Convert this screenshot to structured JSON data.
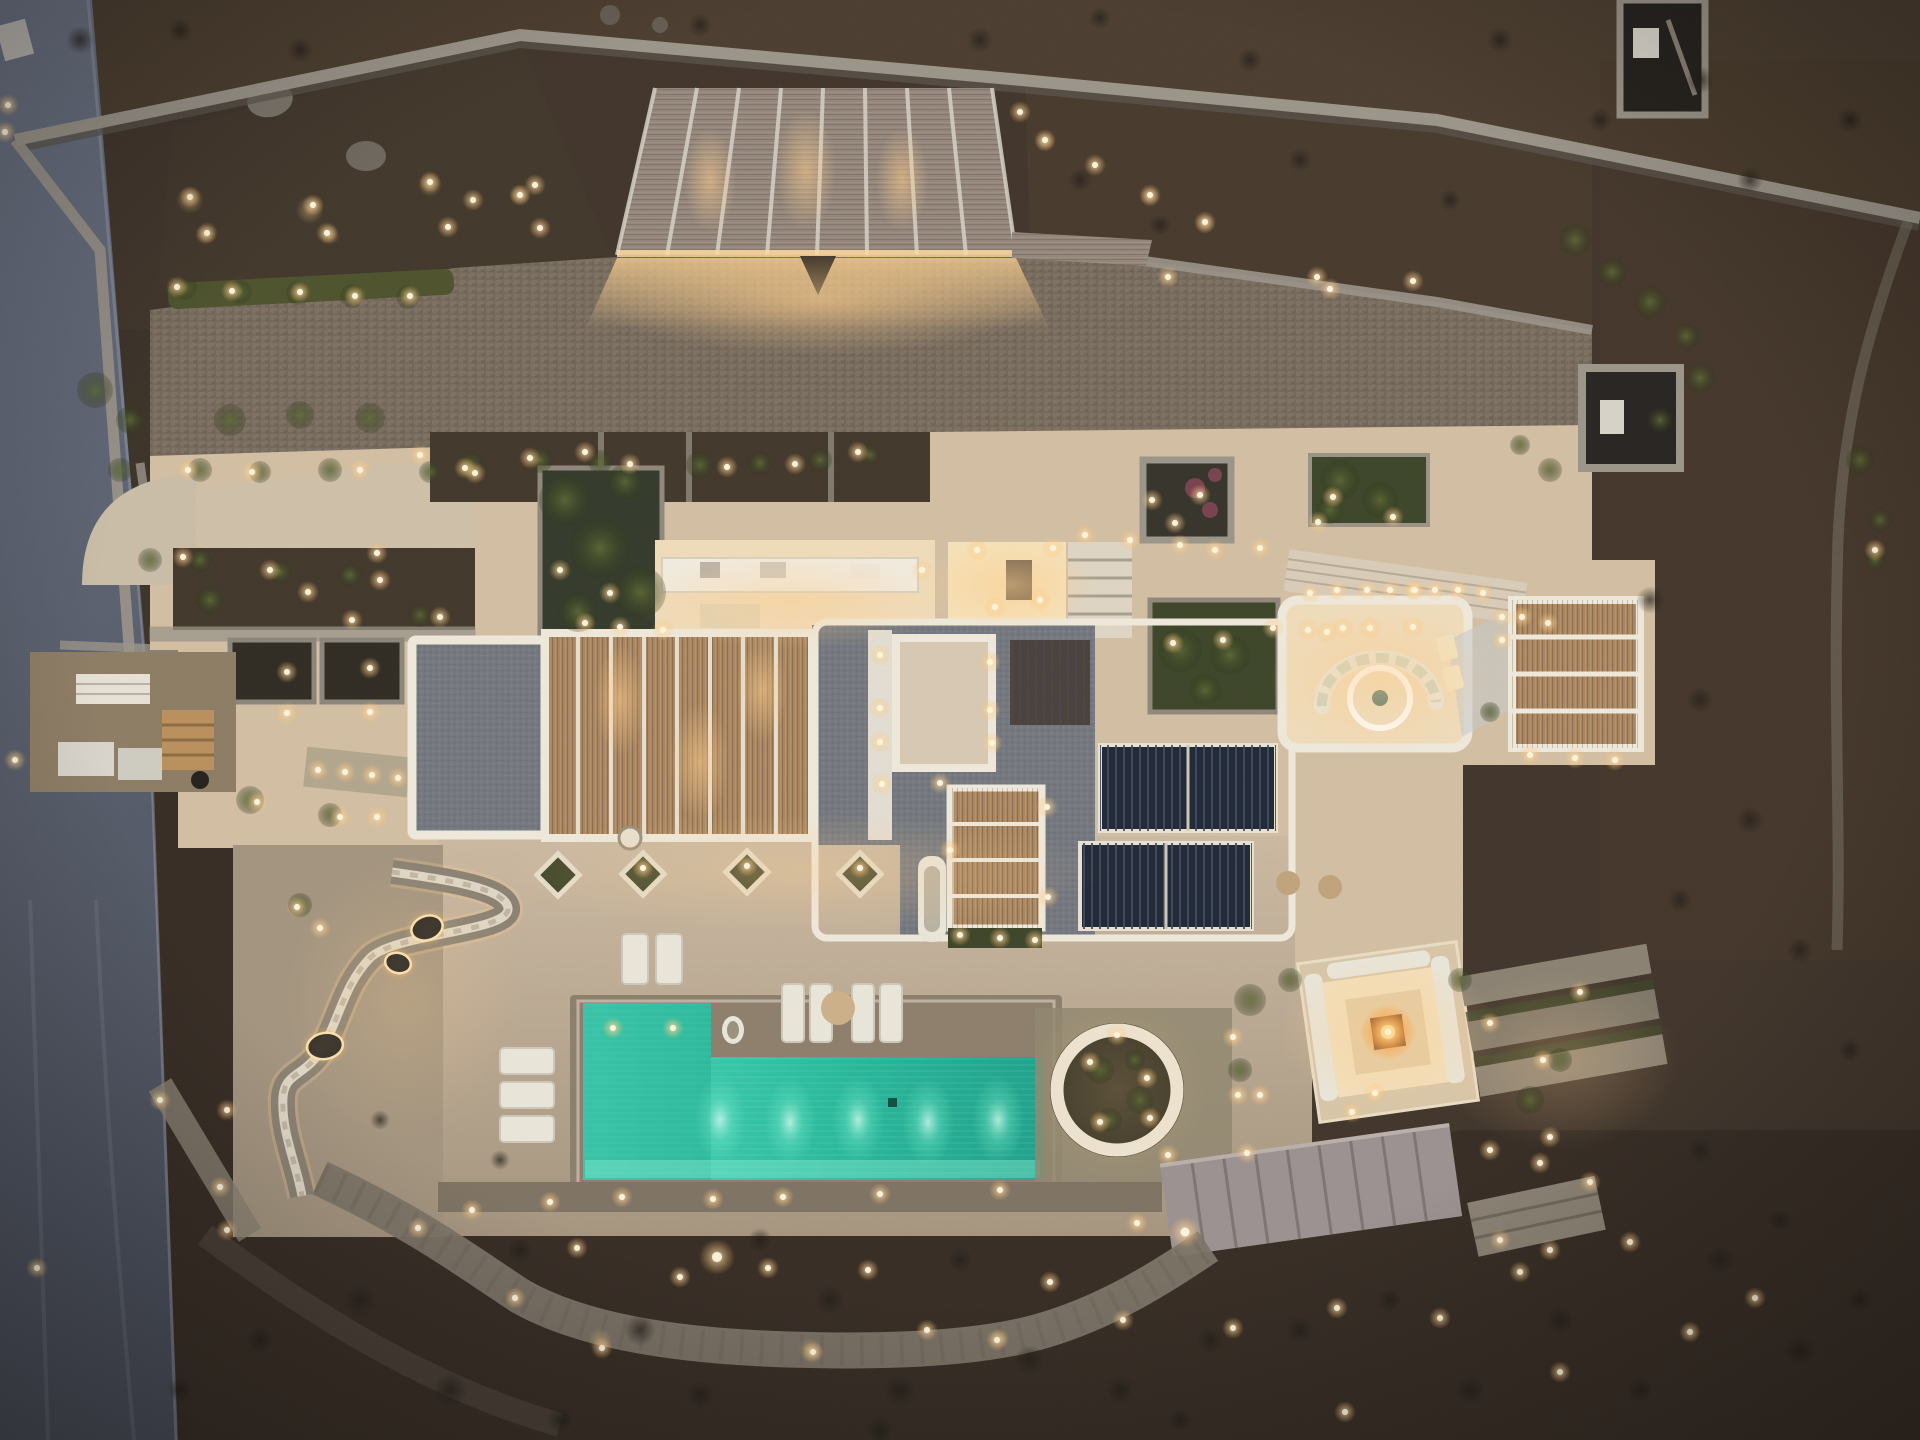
{
  "meta": {
    "label": "Aerial dusk photograph of an illuminated stone villa with pergolas, terraces and a turquoise pool",
    "width": 1920,
    "height": 1440
  },
  "palette": {
    "terrainTop": "#4a3c2e",
    "terrain": "#40342a",
    "terrainBottom": "#352b23",
    "road1": "#6a7183",
    "road2": "#474c59",
    "wall": "#9a9489",
    "wallDark": "#5a544b",
    "cobble": "#75685a",
    "bed": "#41362a",
    "cream": "#d3bfa3",
    "creamHi": "#f0dcba",
    "creamLo": "#b3a28d",
    "white": "#efe9db",
    "thatch": "#93857a",
    "bamboo": "#a9855f",
    "gravel": "#73777e",
    "solar": "#1f2734",
    "pool": "#2abfa3",
    "poolDeep": "#16957e",
    "green": "#3c4428",
    "greenHi": "#5d6a35",
    "stone": "#8a8172",
    "stonePath": "#7c7367",
    "deck": "#c8b59e",
    "deckLo": "#a3947f",
    "sofa": "#e9e6da",
    "cushion": "#c9d2bd",
    "fire": "#ffb057",
    "glow": "#ffd9a0"
  },
  "lights": {
    "warm": [
      [
        190,
        197
      ],
      [
        207,
        233
      ],
      [
        313,
        205
      ],
      [
        327,
        233
      ],
      [
        430,
        182
      ],
      [
        448,
        227
      ],
      [
        473,
        200
      ],
      [
        520,
        195
      ],
      [
        535,
        185
      ],
      [
        540,
        228
      ],
      [
        8,
        105
      ],
      [
        5,
        132
      ],
      [
        177,
        287
      ],
      [
        232,
        291
      ],
      [
        300,
        292
      ],
      [
        355,
        296
      ],
      [
        410,
        296
      ],
      [
        1020,
        112
      ],
      [
        1045,
        140
      ],
      [
        1095,
        165
      ],
      [
        1150,
        195
      ],
      [
        1205,
        222
      ],
      [
        1168,
        277
      ],
      [
        1317,
        277
      ],
      [
        1330,
        289
      ],
      [
        1413,
        281
      ],
      [
        420,
        455
      ],
      [
        465,
        468
      ],
      [
        530,
        458
      ],
      [
        585,
        452
      ],
      [
        630,
        464
      ],
      [
        727,
        467
      ],
      [
        795,
        464
      ],
      [
        858,
        452
      ],
      [
        188,
        470
      ],
      [
        252,
        472
      ],
      [
        360,
        470
      ],
      [
        475,
        473
      ],
      [
        183,
        557
      ],
      [
        270,
        570
      ],
      [
        308,
        592
      ],
      [
        377,
        553
      ],
      [
        380,
        580
      ],
      [
        440,
        617
      ],
      [
        352,
        620
      ],
      [
        287,
        672
      ],
      [
        370,
        668
      ],
      [
        287,
        713
      ],
      [
        370,
        712
      ],
      [
        257,
        802
      ],
      [
        340,
        817
      ],
      [
        377,
        817
      ],
      [
        297,
        907
      ],
      [
        320,
        928
      ],
      [
        318,
        770
      ],
      [
        345,
        772
      ],
      [
        372,
        775
      ],
      [
        398,
        778
      ],
      [
        15,
        760
      ],
      [
        37,
        1268
      ],
      [
        160,
        1100
      ],
      [
        227,
        1110
      ],
      [
        220,
        1187
      ],
      [
        227,
        1230
      ],
      [
        560,
        570
      ],
      [
        610,
        593
      ],
      [
        585,
        623
      ],
      [
        620,
        627
      ],
      [
        663,
        630
      ],
      [
        922,
        570
      ],
      [
        977,
        550
      ],
      [
        1053,
        548
      ],
      [
        1040,
        600
      ],
      [
        995,
        607
      ],
      [
        880,
        655
      ],
      [
        880,
        708
      ],
      [
        880,
        742
      ],
      [
        882,
        784
      ],
      [
        990,
        662
      ],
      [
        990,
        710
      ],
      [
        992,
        743
      ],
      [
        940,
        783
      ],
      [
        950,
        850
      ],
      [
        1047,
        807
      ],
      [
        1048,
        897
      ],
      [
        1173,
        643
      ],
      [
        1223,
        640
      ],
      [
        1200,
        495
      ],
      [
        1175,
        523
      ],
      [
        1152,
        500
      ],
      [
        1333,
        497
      ],
      [
        1393,
        517
      ],
      [
        1318,
        522
      ],
      [
        1085,
        535
      ],
      [
        1130,
        540
      ],
      [
        1180,
        545
      ],
      [
        1215,
        550
      ],
      [
        1260,
        548
      ],
      [
        1310,
        593
      ],
      [
        1337,
        590
      ],
      [
        1367,
        590
      ],
      [
        1390,
        590
      ],
      [
        1413,
        590
      ],
      [
        1435,
        590
      ],
      [
        1458,
        590
      ],
      [
        1483,
        593
      ],
      [
        1502,
        617
      ],
      [
        1502,
        640
      ],
      [
        1522,
        617
      ],
      [
        1548,
        623
      ],
      [
        1273,
        628
      ],
      [
        1308,
        630
      ],
      [
        1343,
        628
      ],
      [
        1327,
        632
      ],
      [
        1370,
        628
      ],
      [
        1413,
        627
      ],
      [
        1415,
        590
      ],
      [
        1530,
        755
      ],
      [
        1575,
        758
      ],
      [
        1615,
        760
      ],
      [
        1875,
        550
      ],
      [
        960,
        935
      ],
      [
        1000,
        938
      ],
      [
        1035,
        940
      ],
      [
        643,
        868
      ],
      [
        747,
        866
      ],
      [
        860,
        868
      ],
      [
        613,
        1028
      ],
      [
        673,
        1028
      ],
      [
        472,
        1210
      ],
      [
        550,
        1202
      ],
      [
        622,
        1197
      ],
      [
        713,
        1199
      ],
      [
        783,
        1197
      ],
      [
        880,
        1194
      ],
      [
        1000,
        1190
      ],
      [
        1090,
        1062
      ],
      [
        1147,
        1078
      ],
      [
        1100,
        1122
      ],
      [
        1150,
        1118
      ],
      [
        1117,
        1035
      ],
      [
        1233,
        1037
      ],
      [
        1238,
        1095
      ],
      [
        1260,
        1095
      ],
      [
        1375,
        1093
      ],
      [
        1352,
        1112
      ],
      [
        1168,
        1155
      ],
      [
        1247,
        1153
      ],
      [
        1137,
        1223
      ],
      [
        418,
        1228
      ],
      [
        515,
        1298
      ],
      [
        577,
        1248
      ],
      [
        602,
        1348
      ],
      [
        680,
        1277
      ],
      [
        768,
        1268
      ],
      [
        813,
        1352
      ],
      [
        868,
        1270
      ],
      [
        927,
        1330
      ],
      [
        997,
        1340
      ],
      [
        1050,
        1282
      ],
      [
        1123,
        1320
      ],
      [
        1233,
        1328
      ],
      [
        1337,
        1308
      ],
      [
        1440,
        1318
      ],
      [
        1520,
        1272
      ],
      [
        1560,
        1372
      ],
      [
        1630,
        1242
      ],
      [
        1690,
        1332
      ],
      [
        1755,
        1298
      ],
      [
        1345,
        1412
      ],
      [
        1490,
        1023
      ],
      [
        1543,
        1060
      ],
      [
        1580,
        992
      ],
      [
        1550,
        1137
      ],
      [
        1490,
        1150
      ],
      [
        1540,
        1163
      ],
      [
        1590,
        1182
      ],
      [
        1500,
        1240
      ],
      [
        1550,
        1250
      ],
      [
        717,
        1257,
        18
      ],
      [
        1185,
        1232,
        16
      ]
    ],
    "pool_glows": [
      [
        720,
        1120
      ],
      [
        790,
        1122
      ],
      [
        858,
        1120
      ],
      [
        928,
        1122
      ],
      [
        998,
        1120
      ]
    ],
    "fire": [
      1388,
      1032
    ],
    "bench_cutouts": [
      [
        427,
        928,
        16,
        12,
        -20
      ],
      [
        398,
        963,
        13,
        10,
        15
      ],
      [
        325,
        1046,
        18,
        13,
        -10
      ]
    ]
  },
  "vegetation": {
    "greens": [
      [
        565,
        500,
        26
      ],
      [
        600,
        548,
        30
      ],
      [
        640,
        592,
        26
      ],
      [
        578,
        612,
        20
      ],
      [
        625,
        482,
        18
      ],
      [
        1180,
        650,
        22
      ],
      [
        1230,
        655,
        20
      ],
      [
        1205,
        690,
        16
      ],
      [
        1340,
        480,
        20
      ],
      [
        1380,
        500,
        18
      ],
      [
        1330,
        510,
        14
      ],
      [
        1575,
        240,
        16
      ],
      [
        1612,
        272,
        14
      ],
      [
        1650,
        302,
        16
      ],
      [
        1686,
        336,
        13
      ],
      [
        1700,
        378,
        15
      ],
      [
        1660,
        420,
        12
      ],
      [
        1860,
        460,
        14
      ],
      [
        1880,
        520,
        12
      ],
      [
        1875,
        560,
        10
      ],
      [
        1550,
        470,
        12
      ],
      [
        1520,
        445,
        10
      ],
      [
        95,
        390,
        18
      ],
      [
        130,
        420,
        14
      ],
      [
        230,
        420,
        16
      ],
      [
        300,
        415,
        14
      ],
      [
        370,
        418,
        15
      ],
      [
        120,
        470,
        12
      ],
      [
        210,
        600,
        14
      ],
      [
        150,
        560,
        12
      ],
      [
        185,
        288,
        12
      ],
      [
        240,
        292,
        12
      ],
      [
        298,
        293,
        12
      ],
      [
        352,
        296,
        12
      ],
      [
        408,
        297,
        12
      ],
      [
        470,
        465,
        14
      ],
      [
        540,
        460,
        13
      ],
      [
        600,
        462,
        12
      ],
      [
        700,
        465,
        14
      ],
      [
        760,
        463,
        12
      ],
      [
        820,
        460,
        12
      ],
      [
        870,
        455,
        10
      ],
      [
        200,
        470,
        12
      ],
      [
        260,
        472,
        11
      ],
      [
        330,
        470,
        12
      ],
      [
        430,
        472,
        11
      ],
      [
        200,
        560,
        12
      ],
      [
        280,
        572,
        12
      ],
      [
        350,
        575,
        12
      ],
      [
        420,
        615,
        12
      ],
      [
        250,
        800,
        14
      ],
      [
        330,
        815,
        12
      ],
      [
        300,
        905,
        12
      ],
      [
        1250,
        1000,
        16
      ],
      [
        1290,
        980,
        12
      ],
      [
        1240,
        1070,
        12
      ],
      [
        1460,
        980,
        12
      ],
      [
        1530,
        1100,
        14
      ],
      [
        1560,
        1060,
        12
      ],
      [
        1100,
        1070,
        14
      ],
      [
        1140,
        1100,
        14
      ],
      [
        1110,
        1120,
        12
      ],
      [
        1135,
        1060,
        10
      ],
      [
        1490,
        712,
        10
      ]
    ],
    "grasses": [
      [
        190,
        200,
        14
      ],
      [
        310,
        210,
        14
      ],
      [
        430,
        185,
        12
      ],
      [
        520,
        195,
        10
      ],
      [
        205,
        235,
        10
      ],
      [
        330,
        235,
        10
      ],
      [
        1045,
        142,
        10
      ],
      [
        1150,
        197,
        10
      ],
      [
        1205,
        224,
        10
      ],
      [
        600,
        1340,
        12
      ],
      [
        810,
        1350,
        12
      ],
      [
        1000,
        1338,
        10
      ]
    ],
    "flowers": [
      [
        1195,
        488,
        10
      ],
      [
        1210,
        510,
        8
      ],
      [
        1215,
        475,
        7
      ]
    ],
    "bushes": [
      [
        360,
        1300,
        16
      ],
      [
        450,
        1390,
        18
      ],
      [
        520,
        1250,
        13
      ],
      [
        640,
        1330,
        16
      ],
      [
        700,
        1395,
        14
      ],
      [
        760,
        1240,
        12
      ],
      [
        830,
        1300,
        15
      ],
      [
        900,
        1390,
        16
      ],
      [
        960,
        1260,
        12
      ],
      [
        1030,
        1360,
        15
      ],
      [
        1120,
        1390,
        14
      ],
      [
        1210,
        1340,
        13
      ],
      [
        1300,
        1330,
        14
      ],
      [
        1390,
        1300,
        12
      ],
      [
        1470,
        1390,
        15
      ],
      [
        1560,
        1320,
        14
      ],
      [
        1640,
        1390,
        13
      ],
      [
        1720,
        1260,
        14
      ],
      [
        1800,
        1350,
        15
      ],
      [
        1860,
        1300,
        12
      ],
      [
        560,
        1420,
        13
      ],
      [
        880,
        1430,
        14
      ],
      [
        1180,
        1420,
        12
      ],
      [
        260,
        1340,
        14
      ],
      [
        180,
        1390,
        12
      ],
      [
        80,
        40,
        14
      ],
      [
        180,
        30,
        12
      ],
      [
        300,
        50,
        13
      ],
      [
        700,
        25,
        12
      ],
      [
        980,
        40,
        13
      ],
      [
        1100,
        18,
        11
      ],
      [
        1250,
        60,
        12
      ],
      [
        1500,
        40,
        13
      ],
      [
        1700,
        80,
        14
      ],
      [
        1850,
        120,
        13
      ],
      [
        1080,
        180,
        12
      ],
      [
        1160,
        225,
        11
      ],
      [
        1300,
        160,
        12
      ],
      [
        1450,
        200,
        11
      ],
      [
        1600,
        120,
        12
      ],
      [
        1750,
        180,
        13
      ],
      [
        1650,
        600,
        14
      ],
      [
        1700,
        700,
        13
      ],
      [
        1750,
        820,
        14
      ],
      [
        1680,
        900,
        12
      ],
      [
        1800,
        950,
        13
      ],
      [
        1850,
        1050,
        12
      ],
      [
        1700,
        1150,
        13
      ],
      [
        1780,
        1220,
        12
      ],
      [
        500,
        1160,
        10
      ],
      [
        380,
        1120,
        10
      ]
    ]
  }
}
